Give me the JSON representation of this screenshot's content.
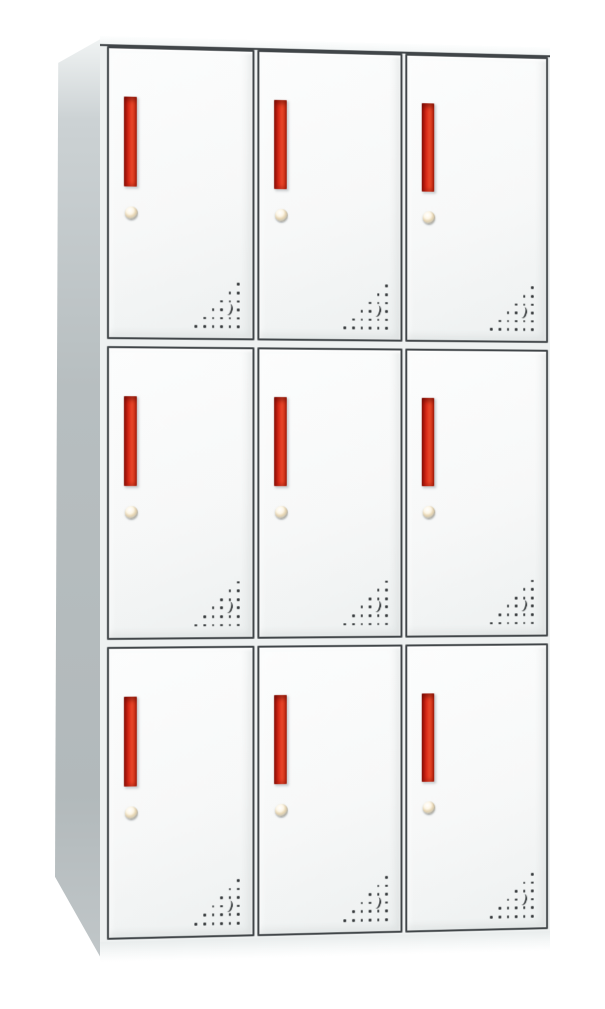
{
  "scene": {
    "description": "Product photo of a white steel office locker cabinet with nine doors",
    "background": "#ffffff"
  },
  "cabinet": {
    "rows": 3,
    "columns": 3,
    "door_count": 9,
    "doors": [
      {
        "row": 1,
        "col": 1
      },
      {
        "row": 1,
        "col": 2
      },
      {
        "row": 1,
        "col": 3
      },
      {
        "row": 2,
        "col": 1
      },
      {
        "row": 2,
        "col": 2
      },
      {
        "row": 2,
        "col": 3
      },
      {
        "row": 3,
        "col": 1
      },
      {
        "row": 3,
        "col": 2
      },
      {
        "row": 3,
        "col": 3
      }
    ],
    "door": {
      "handle": "vertical-red-recessed-bar",
      "lock": "round-cam-keyhole",
      "vent": {
        "shape": "right-triangle-of-holes",
        "rows": 6,
        "dots_per_row": [
          1,
          2,
          3,
          4,
          5,
          6
        ],
        "crescent_row": 4,
        "crescent_from_right": 2
      }
    },
    "colors": {
      "background": "#ffffff",
      "door_face": "#f7f8f8",
      "door_border": "#404548",
      "frame_gap": "#eef1f1",
      "side_panel": "#b7bec0",
      "side_panel_top": "#eff2f2",
      "top_face": "#fdfefe",
      "base": "#e9eded",
      "handle_red": "#da2b18",
      "handle_red_bright": "#e8472a",
      "handle_red_dark": "#8d120b",
      "lock_gold": "#e4d2ae",
      "lock_metal": "#a9afb1",
      "vent_dot": "#34383a"
    }
  }
}
